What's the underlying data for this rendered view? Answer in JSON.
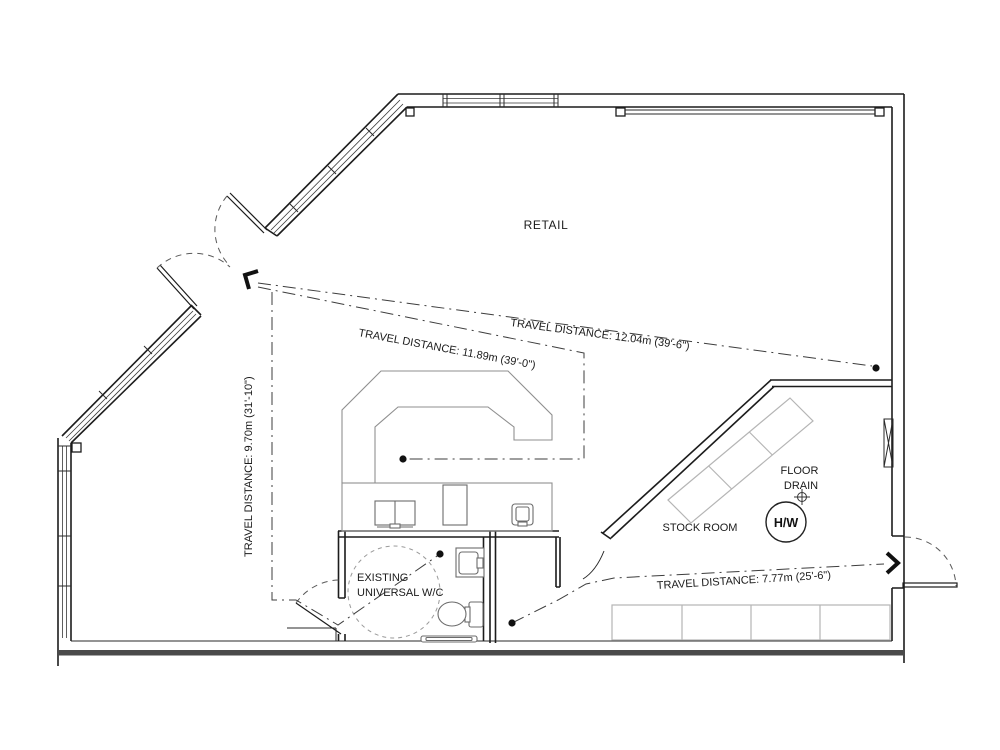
{
  "drawing": {
    "rooms": {
      "retail": "RETAIL",
      "stock_room": "STOCK ROOM",
      "wc_line1": "EXISTING",
      "wc_line2": "UNIVERSAL W/C"
    },
    "equipment": {
      "floor_drain_line1": "FLOOR",
      "floor_drain_line2": "DRAIN",
      "hot_water_tank": "H/W"
    },
    "travel_routes": [
      {
        "id": "route-to-rear-exit",
        "label": "TRAVEL DISTANCE: 12.04m (39'-6\")",
        "meters": 12.04,
        "imperial": "39'-6\""
      },
      {
        "id": "route-to-counter",
        "label": "TRAVEL DISTANCE: 11.89m (39'-0\")",
        "meters": 11.89,
        "imperial": "39'-0\""
      },
      {
        "id": "route-to-wc",
        "label": "TRAVEL DISTANCE: 9.70m (31'-10\")",
        "meters": 9.7,
        "imperial": "31'-10\""
      },
      {
        "id": "route-wc-to-side-exit",
        "label": "TRAVEL DISTANCE: 7.77m (25'-6\")",
        "meters": 7.77,
        "imperial": "25'-6\""
      }
    ],
    "colors": {
      "wall": "#1c1c1c",
      "route": "#3d3d3d",
      "fixture": "#6b6b6b",
      "counter": "#8f8f8f",
      "shelving": "#b5b5b5",
      "text": "#1b1b1b"
    }
  }
}
